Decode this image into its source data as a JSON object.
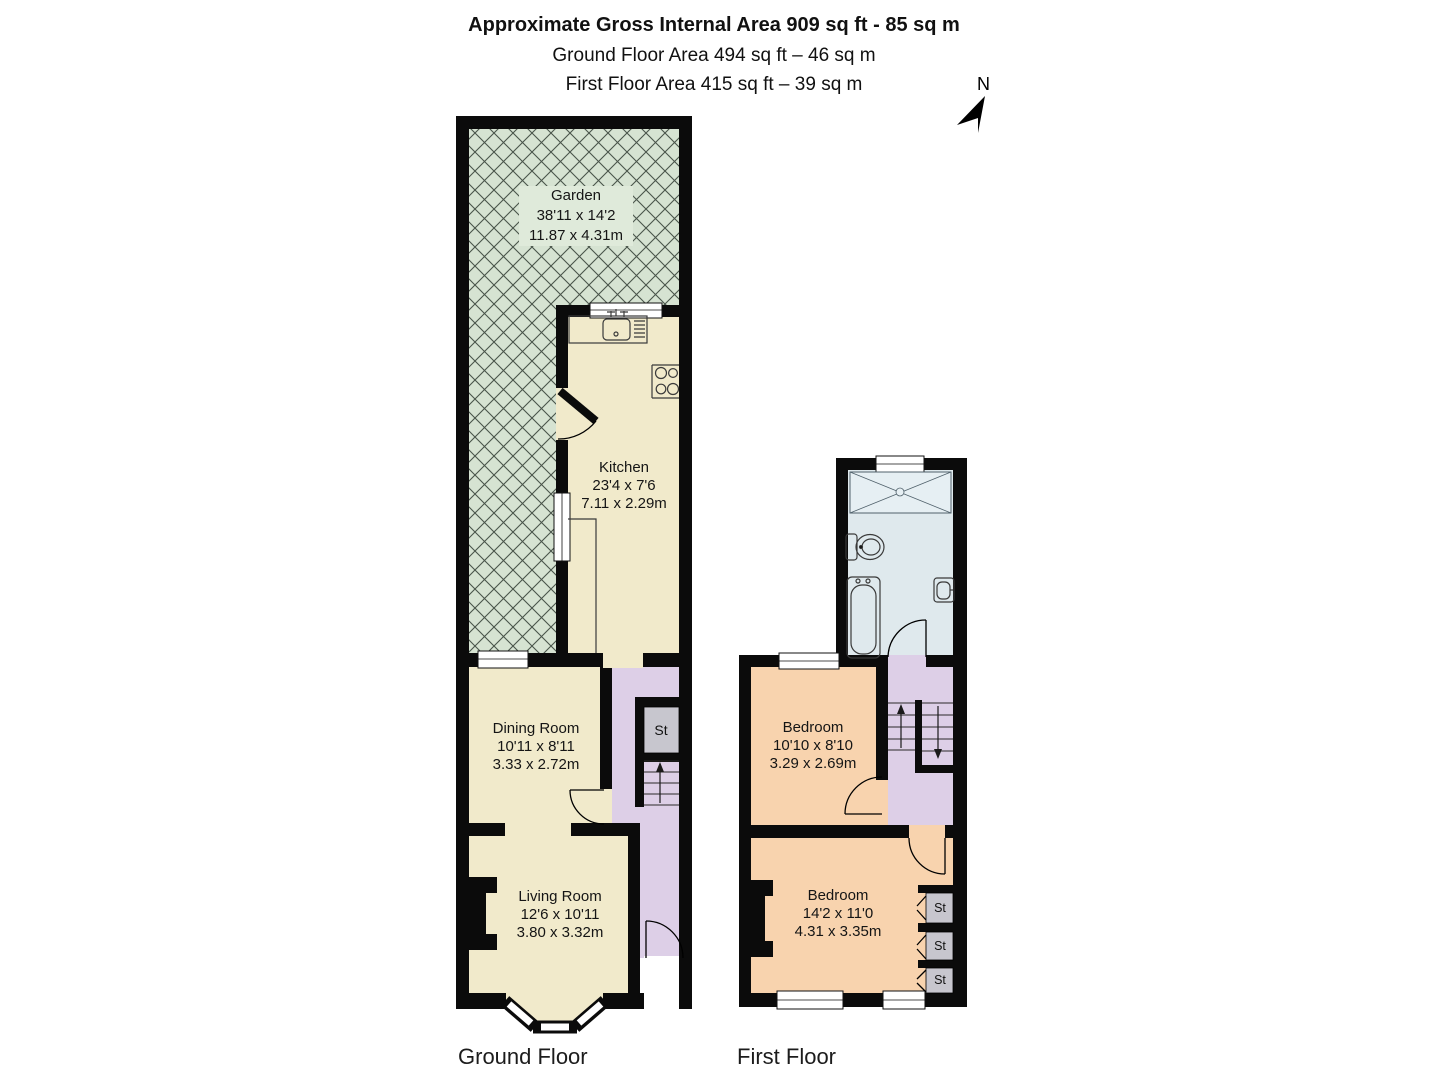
{
  "header": {
    "title": "Approximate Gross Internal Area 909 sq ft - 85 sq m",
    "ground_line": "Ground Floor Area 494 sq ft – 46 sq m",
    "first_line": "First Floor Area 415 sq ft – 39 sq m"
  },
  "compass": {
    "north_label": "N"
  },
  "ground_floor": {
    "caption": "Ground Floor",
    "garden": {
      "name": "Garden",
      "size_imperial": "38'11 x 14'2",
      "size_metric": "11.87 x 4.31m"
    },
    "kitchen": {
      "name": "Kitchen",
      "size_imperial": "23'4 x 7'6",
      "size_metric": "7.11 x 2.29m"
    },
    "dining_room": {
      "name": "Dining Room",
      "size_imperial": "10'11 x 8'11",
      "size_metric": "3.33 x 2.72m"
    },
    "living_room": {
      "name": "Living Room",
      "size_imperial": "12'6 x 10'11",
      "size_metric": "3.80 x 3.32m"
    },
    "storage": {
      "label": "St"
    }
  },
  "first_floor": {
    "caption": "First Floor",
    "bedroom_rear": {
      "name": "Bedroom",
      "size_imperial": "10'10 x 8'10",
      "size_metric": "3.29 x 2.69m"
    },
    "bedroom_front": {
      "name": "Bedroom",
      "size_imperial": "14'2 x 11'0",
      "size_metric": "4.31 x 3.35m"
    },
    "storage_1": {
      "label": "St"
    },
    "storage_2": {
      "label": "St"
    },
    "storage_3": {
      "label": "St"
    }
  },
  "colors": {
    "wall": "#0b0b0b",
    "garden": "#d6e3d2",
    "hatch": "#49544a",
    "cream": "#f1eacb",
    "hall": "#ddcfe7",
    "bathroom": "#dfe9ed",
    "bedroom": "#f8d3ae",
    "storage": "#c7c6ce",
    "fixture_line": "#3a3a3a"
  }
}
